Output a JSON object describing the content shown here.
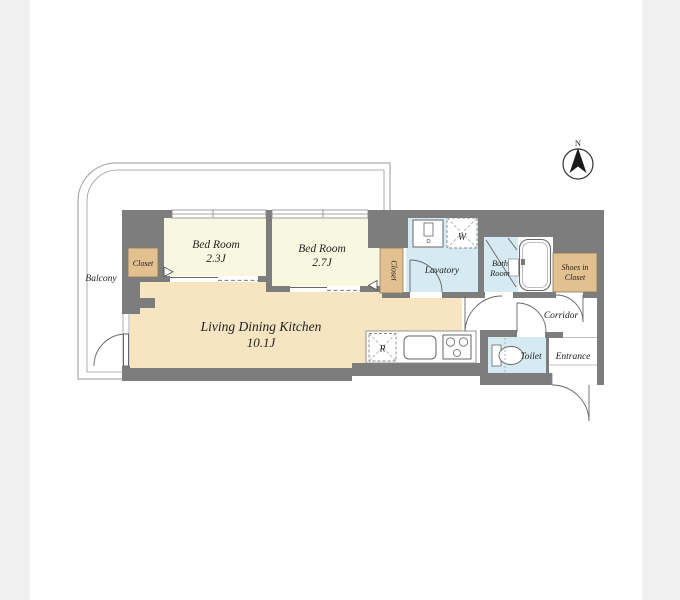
{
  "page": {
    "background": "#ffffff",
    "margin_band_color": "#f0f0f0"
  },
  "palette": {
    "wall": "#7d7d7d",
    "bedroom_floor": "#f8f8e1",
    "ldk_floor": "#f7e5c2",
    "closet_fill": "#e2c08f",
    "wet_area_floor": "#d5eaf3",
    "tub_area": "#fcfcfc",
    "outline": "#999999",
    "fixture_line": "#666666"
  },
  "compass": {
    "north_label": "N"
  },
  "rooms": {
    "balcony": {
      "label": "Balcony"
    },
    "bedroom1": {
      "label": "Bed Room",
      "size": "2.3J"
    },
    "bedroom2": {
      "label": "Bed Room",
      "size": "2.7J"
    },
    "ldk": {
      "label": "Living Dining Kitchen",
      "size": "10.1J"
    },
    "closet_bedroom1": {
      "label": "Closet"
    },
    "closet_bedroom2": {
      "label": "Closet"
    },
    "shoes_closet": {
      "line1": "Shoes in",
      "line2": "Closet"
    },
    "lavatory": {
      "label": "Lavatory"
    },
    "bathroom": {
      "line1": "Bath",
      "line2": "Room"
    },
    "corridor": {
      "label": "Corridor"
    },
    "toilet": {
      "label": "Toilet"
    },
    "entrance": {
      "label": "Entrance"
    }
  },
  "appliances": {
    "washing_machine": "W",
    "refrigerator": "R"
  }
}
